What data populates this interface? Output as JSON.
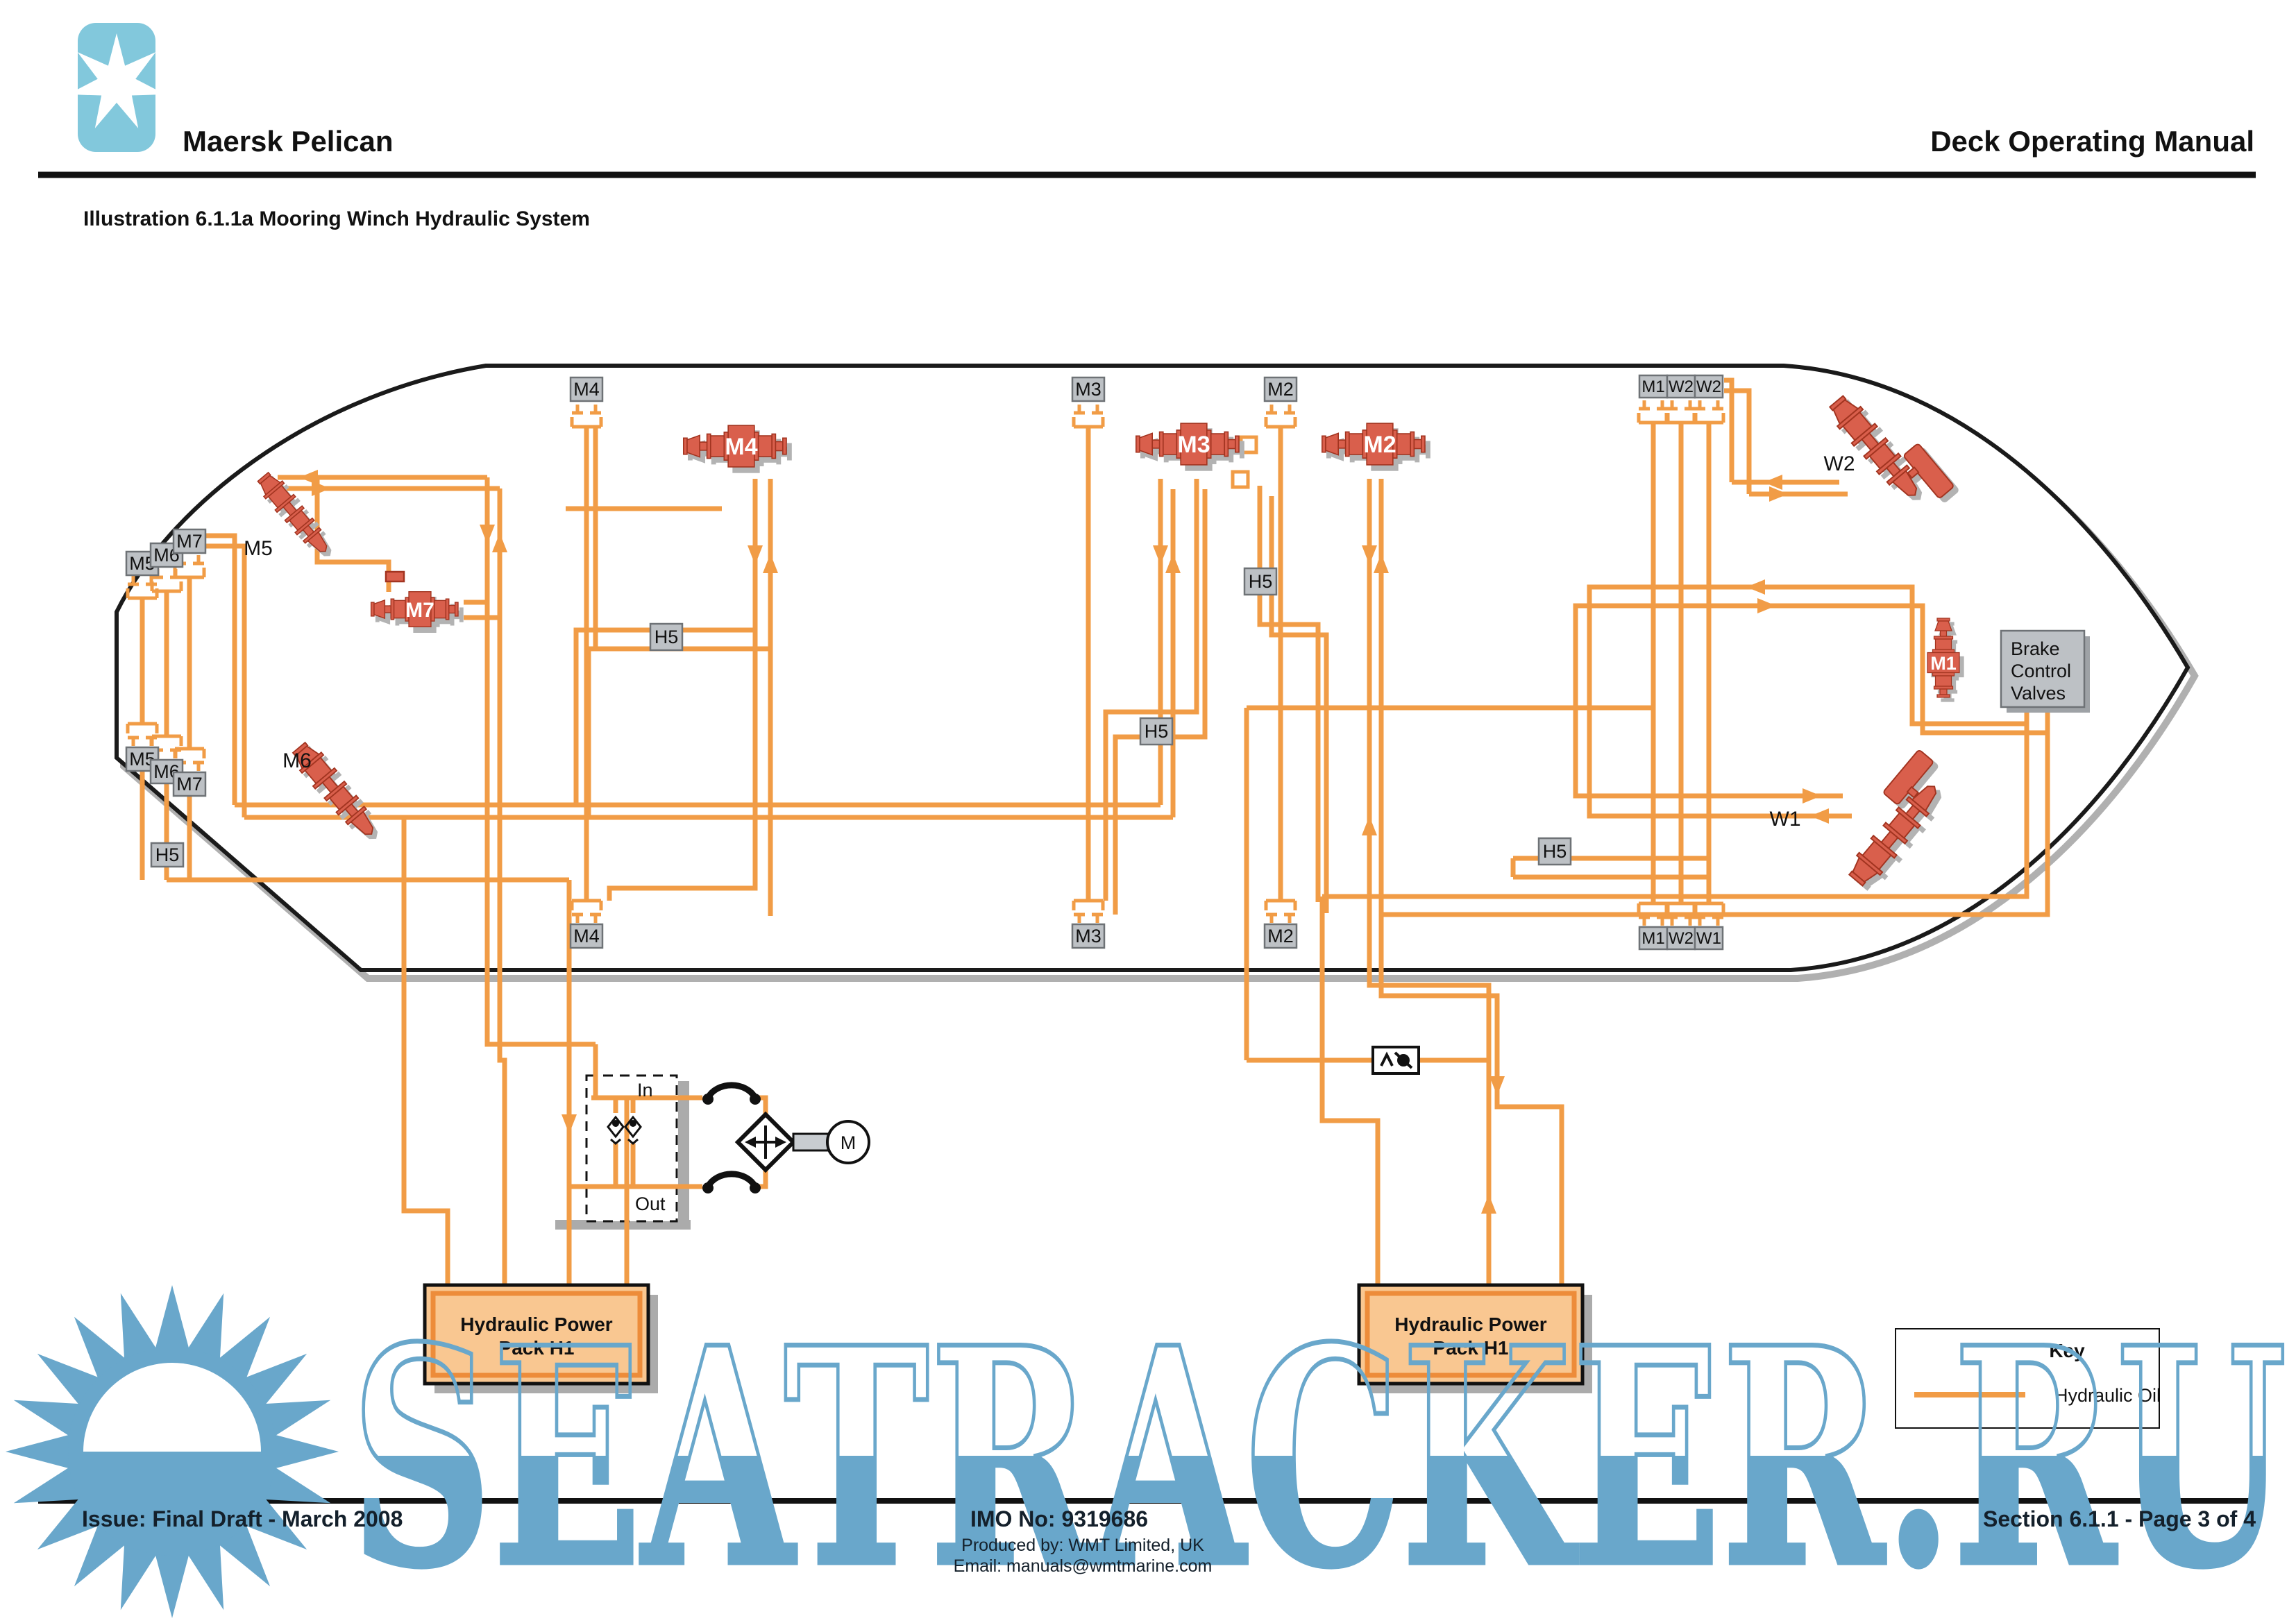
{
  "header": {
    "logo": "maersk-seven-point-star",
    "ship_name": "Maersk Pelican",
    "manual_title": "Deck Operating Manual"
  },
  "caption": "Illustration 6.1.1a Mooring Winch Hydraulic System",
  "labels": {
    "M1": "M1",
    "M2": "M2",
    "M3": "M3",
    "M4": "M4",
    "M5": "M5",
    "M6": "M6",
    "M7": "M7",
    "W1": "W1",
    "W2": "W2",
    "H5": "H5"
  },
  "brake_box": {
    "line1": "Brake",
    "line2": "Control",
    "line3": "Valves"
  },
  "power_pack": {
    "line1": "Hydraulic Power",
    "line2": "Pack H1"
  },
  "emergency_pump": {
    "in_label": "In",
    "out_label": "Out",
    "motor": "M"
  },
  "key": {
    "title": "Key",
    "entry": "Hydraulic Oil",
    "line_color": "#F19C46"
  },
  "footer": {
    "issue": "Issue: Final Draft  -  March 2008",
    "imo": "IMO No: 9319686",
    "produced_by": "Produced by: WMT Limited, UK",
    "email": "Email: manuals@wmtmarine.com",
    "section": "Section 6.1.1 - Page 3 of 4"
  },
  "watermark": {
    "text": "SEATRACKER.RU",
    "color": "#69A7CB"
  },
  "colors": {
    "pipe": "#F19C46",
    "winch_red": "#D95F4C",
    "label_box": "#BDC1C5",
    "pack_fill": "#F9C791",
    "logo_blue": "#82C8DC"
  }
}
